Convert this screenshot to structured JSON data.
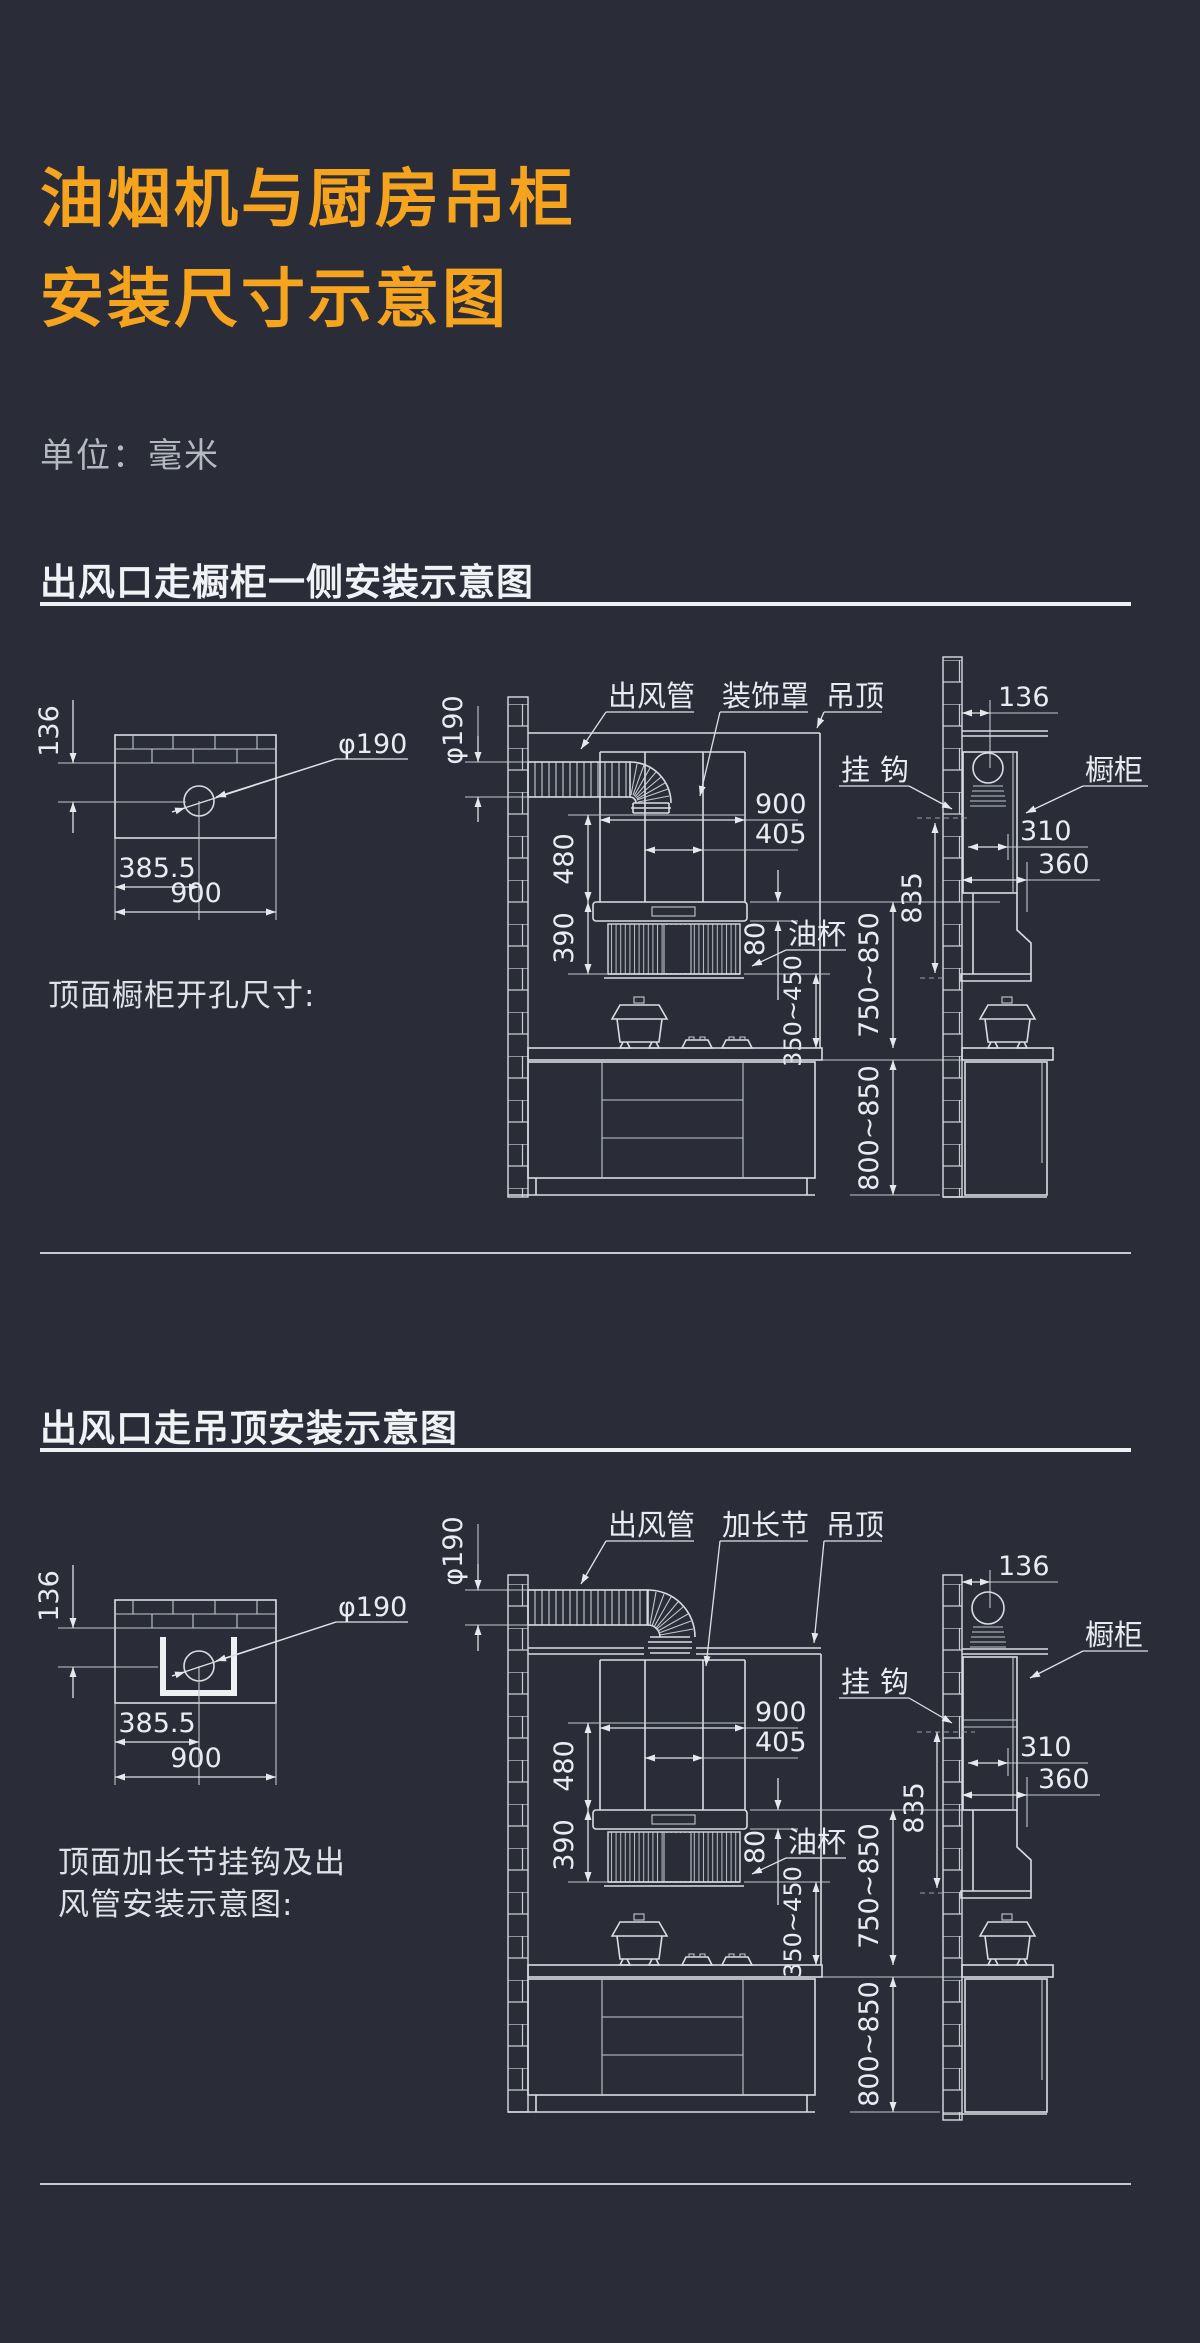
{
  "page": {
    "background": "#2a2d38",
    "accent": "#f6a41e",
    "line_color": "#d9dde2"
  },
  "title": {
    "line1": "油烟机与厨房吊柜",
    "line2": "安装尺寸示意图"
  },
  "unit_label": "单位：毫米",
  "s1": {
    "heading": "出风口走橱柜一侧安装示意图",
    "caption": "顶面橱柜开孔尺寸:",
    "labels": {
      "duct": "出风管",
      "cover": "装饰罩",
      "ceiling": "吊顶",
      "hook": "挂钩",
      "cabinet": "橱柜",
      "cup": "油杯"
    },
    "dims": {
      "hole_off": "136",
      "hole_x": "385.5",
      "cab_w": "900",
      "hole_dia": "φ190",
      "duct_dia": "φ190",
      "chim_h": "480",
      "body_h": "390",
      "hood_w": "900",
      "out_off": "405",
      "cup": "80",
      "louver_gap": "350~450",
      "hang": "750~850",
      "base": "800~850",
      "wall_off": "136",
      "depth1": "310",
      "depth2": "360",
      "hook_h": "835"
    }
  },
  "s2": {
    "heading": "出风口走吊顶安装示意图",
    "caption_line1": "顶面加长节挂钩及出",
    "caption_line2": "风管安装示意图:",
    "labels": {
      "duct": "出风管",
      "ext": "加长节",
      "ceiling": "吊顶",
      "hook": "挂钩",
      "cabinet": "橱柜",
      "cup": "油杯"
    },
    "dims": {
      "hole_off": "136",
      "hole_x": "385.5",
      "cab_w": "900",
      "hole_dia": "φ190",
      "duct_dia": "φ190",
      "chim_h": "480",
      "body_h": "390",
      "hood_w": "900",
      "out_off": "405",
      "cup": "80",
      "louver_gap": "350~450",
      "hang": "750~850",
      "base": "800~850",
      "wall_off": "136",
      "depth1": "310",
      "depth2": "360",
      "hook_h": "835"
    }
  }
}
